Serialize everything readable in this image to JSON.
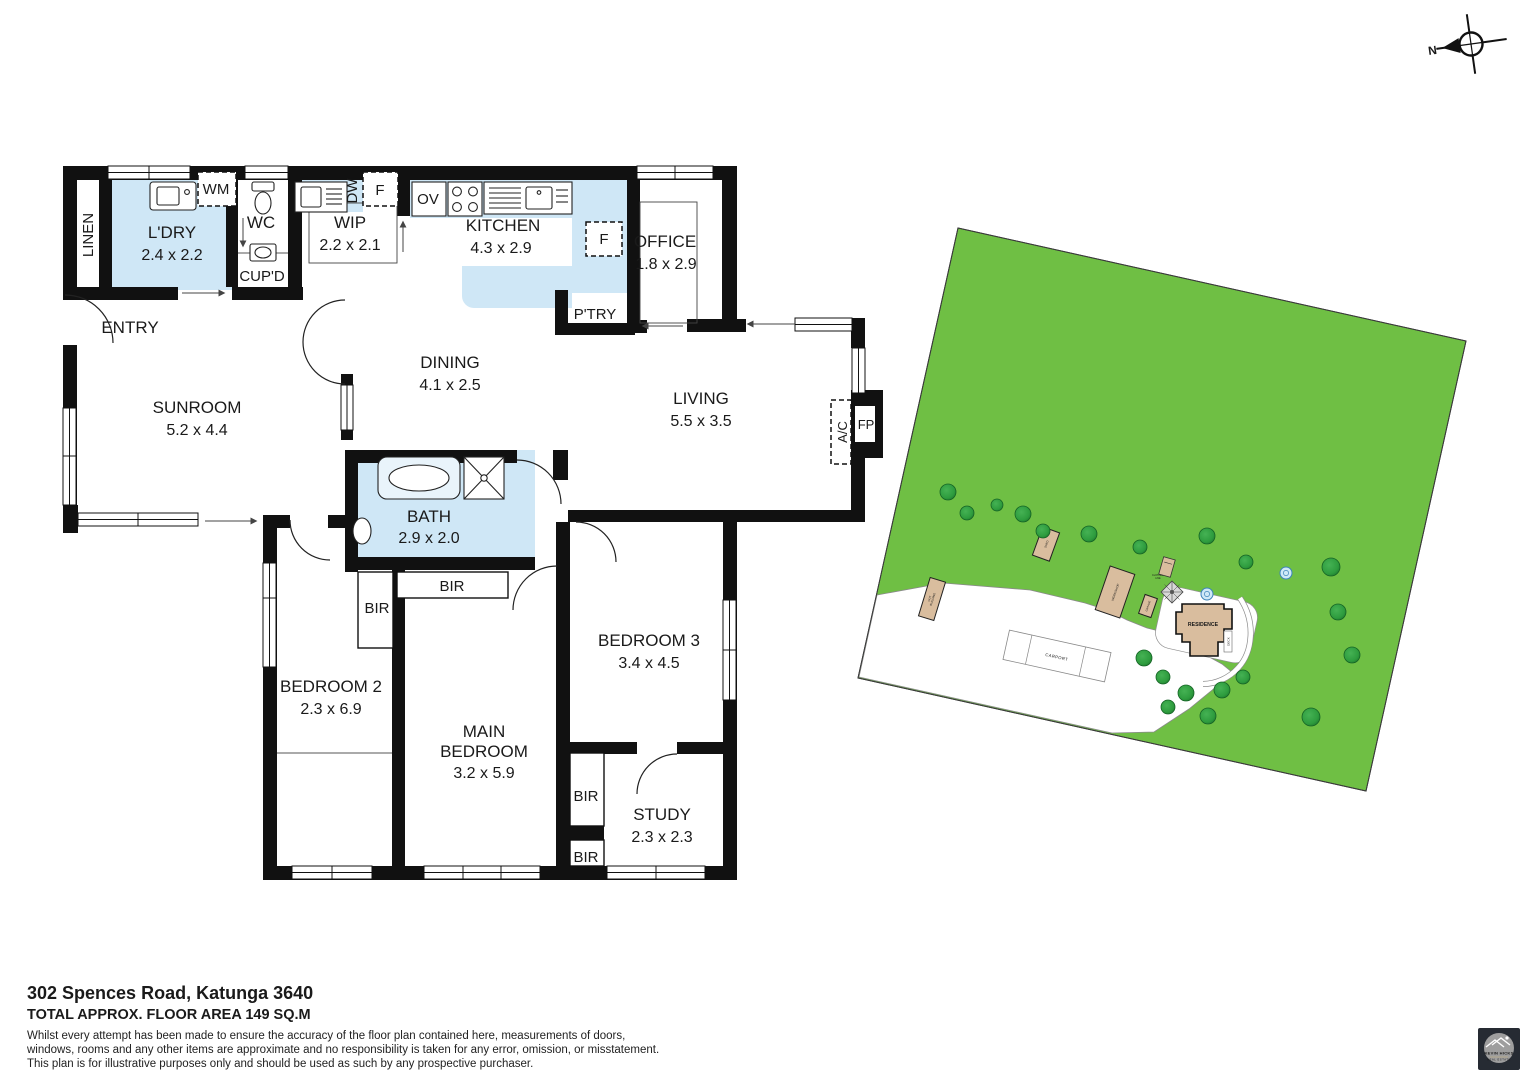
{
  "page": {
    "address": "302 Spences Road, Katunga 3640",
    "floor_area": "TOTAL APPROX. FLOOR AREA 149 SQ.M",
    "disclaimer_line1": "Whilst every attempt has been made to ensure the accuracy of the floor plan contained here, measurements of doors,",
    "disclaimer_line2": "windows, rooms and any other items are approximate and no responsibility is taken for any error, omission, or misstatement.",
    "disclaimer_line3": "This plan is for illustrative purposes only and should be used as such by any prospective purchaser."
  },
  "compass": {
    "north_label": "N"
  },
  "floorplan": {
    "rooms": {
      "linen": {
        "label": "LINEN"
      },
      "ldry": {
        "label": "L'DRY",
        "dims": "2.4 x 2.2"
      },
      "wc": {
        "label": "WC"
      },
      "cupd": {
        "label": "CUP'D"
      },
      "wip": {
        "label": "WIP",
        "dims": "2.2 x 2.1"
      },
      "kitchen": {
        "label": "KITCHEN",
        "dims": "4.3 x 2.9"
      },
      "ptry": {
        "label": "P'TRY"
      },
      "office": {
        "label": "OFFICE",
        "dims": "1.8 x 2.9"
      },
      "entry": {
        "label": "ENTRY"
      },
      "sunroom": {
        "label": "SUNROOM",
        "dims": "5.2 x 4.4"
      },
      "dining": {
        "label": "DINING",
        "dims": "4.1 x 2.5"
      },
      "living": {
        "label": "LIVING",
        "dims": "5.5 x 3.5"
      },
      "bath": {
        "label": "BATH",
        "dims": "2.9 x 2.0"
      },
      "bedroom2": {
        "label": "BEDROOM 2",
        "dims": "2.3 x 6.9"
      },
      "main_bedroom": {
        "line1": "MAIN",
        "line2": "BEDROOM",
        "dims": "3.2 x 5.9"
      },
      "bedroom3": {
        "label": "BEDROOM 3",
        "dims": "3.4 x 4.5"
      },
      "study": {
        "label": "STUDY",
        "dims": "2.3 x 2.3"
      }
    },
    "fixtures": {
      "wm": "WM",
      "dw": "DW",
      "fridge": "F",
      "oven": "OV",
      "ac": "A/C",
      "fp": "FP",
      "bir": "BIR"
    }
  },
  "siteplan": {
    "labels": {
      "residence": "RESIDENCE",
      "deck": "DECK",
      "carport": "CARPORT",
      "garage": "GARAGE",
      "workshop": "WORKSHOP",
      "shed": "SHED",
      "out_building_line1": "OUT",
      "out_building_line2": "BUILDING",
      "clothes_line_line1": "CLOTHES",
      "clothes_line_line2": "LINE"
    },
    "colors": {
      "grass": "#6fbf44",
      "tree": "#2e9c3e",
      "building": "#d9bd9e",
      "wet_area": "#cfe7f6"
    }
  },
  "logo": {
    "name": "KEVIN HICKS",
    "tagline": "REAL ESTATE"
  }
}
